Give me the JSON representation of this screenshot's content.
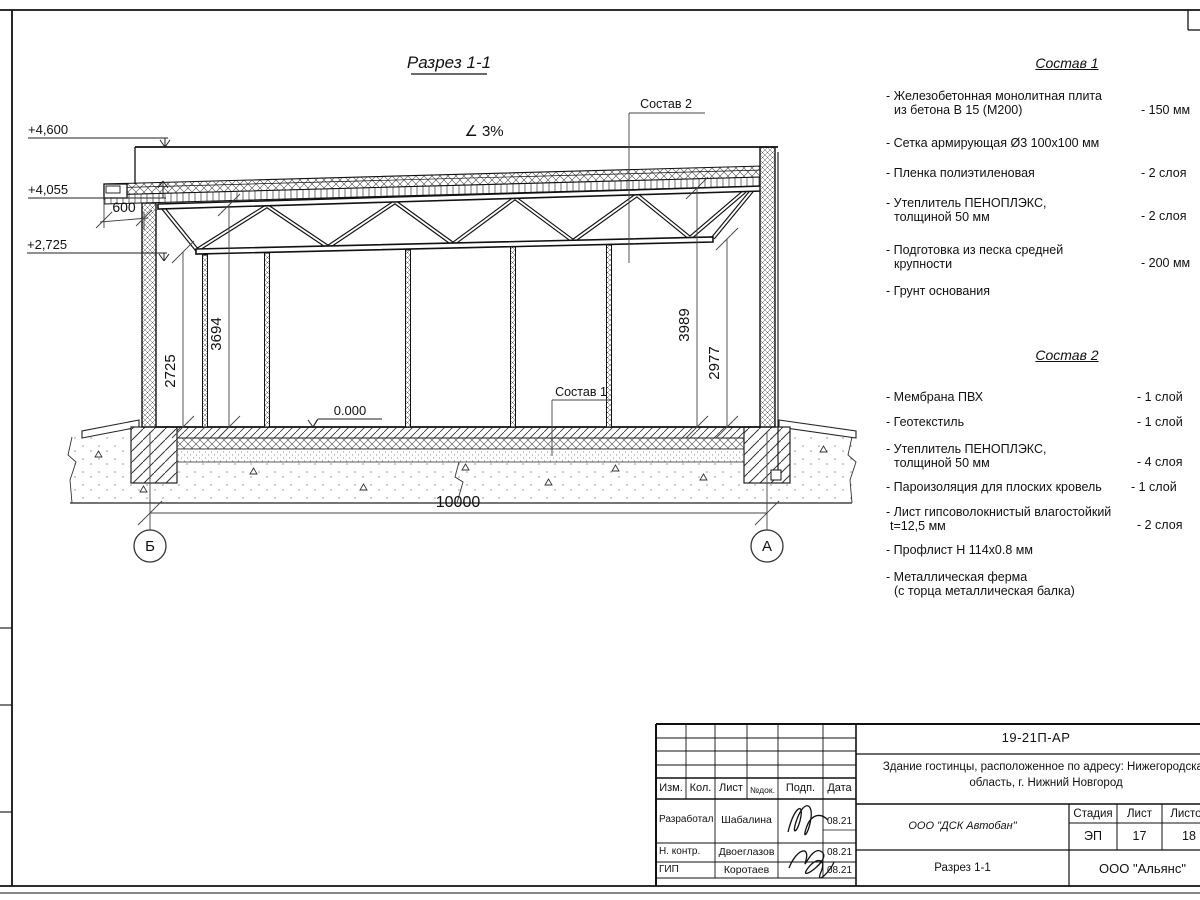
{
  "drawing_title": "Разрез 1-1",
  "slope_label": "∠ 3%",
  "elevations": {
    "roof_top": "+4,600",
    "parapet": "+4,055",
    "truss": "+2,725",
    "floor": "0.000"
  },
  "dimensions": {
    "overhang": "600",
    "span": "10000",
    "left_inner": "2725",
    "left_outer": "3694",
    "right_inner": "3989",
    "right_outer": "2977"
  },
  "axes": {
    "left": "Б",
    "right": "А"
  },
  "callouts": {
    "roof": "Состав 2",
    "floor": "Состав 1"
  },
  "sostav1": {
    "title": "Состав 1",
    "items": [
      {
        "line1": "- Железобетонная  монолитная плита",
        "line2": "из бетона В 15 (М200)",
        "value": "- 150 мм"
      },
      {
        "line1": "- Сетка армирующая Ø3 100х100 мм",
        "line2": "",
        "value": ""
      },
      {
        "line1": "- Пленка полиэтиленовая",
        "line2": "",
        "value": "- 2 слоя"
      },
      {
        "line1": "- Утеплитель ПЕНОПЛЭКС,",
        "line2": "толщиной 50 мм",
        "value": "- 2 слоя"
      },
      {
        "line1": "- Подготовка из песка средней",
        "line2": "крупности",
        "value": "- 200 мм"
      },
      {
        "line1": "- Грунт основания",
        "line2": "",
        "value": ""
      }
    ]
  },
  "sostav2": {
    "title": "Состав 2",
    "items": [
      {
        "line1": "- Мембрана ПВХ",
        "line2": "",
        "value": "- 1 слой"
      },
      {
        "line1": "- Геотекстиль",
        "line2": "",
        "value": "- 1 слой"
      },
      {
        "line1": "- Утеплитель ПЕНОПЛЭКС,",
        "line2": "толщиной 50 мм",
        "value": "- 4 слоя"
      },
      {
        "line1": "- Пароизоляция для плоских кровель",
        "line2": "",
        "value": "- 1 слой"
      },
      {
        "line1": "- Лист гипсоволокнистый влагостойкий",
        "line2": "t=12,5 мм",
        "value": "- 2 слоя"
      },
      {
        "line1": "- Профлист Н 114х0.8 мм",
        "line2": "",
        "value": ""
      },
      {
        "line1": "- Металлическая ферма",
        "line2": "(с торца металлическая балка)",
        "value": ""
      }
    ]
  },
  "titleblock": {
    "doc_number": "19-21П-АР",
    "project_line1": "Здание гостинцы, расположенное по адресу: Нижегородская",
    "project_line2": "область, г. Нижний Новгород",
    "col_izm": "Изм.",
    "col_kol": "Кол.",
    "col_list": "Лист",
    "col_ndok": "№док.",
    "col_podp": "Подп.",
    "col_data": "Дата",
    "rows": [
      {
        "role": "Разработал",
        "name": "Шабалина",
        "date": "08.21"
      },
      {
        "role": "Н. контр.",
        "name": "Двоеглазов",
        "date": "08.21"
      },
      {
        "role": "ГИП",
        "name": "Коротаев",
        "date": "08.21"
      }
    ],
    "company": "ООО \"ДСК Автобан\"",
    "stage_label": "Стадия",
    "sheet_label": "Лист",
    "sheets_label": "Листов",
    "stage": "ЭП",
    "sheet": "17",
    "sheets": "18",
    "view_name": "Разрез 1-1",
    "org": "ООО \"Альянс\""
  }
}
